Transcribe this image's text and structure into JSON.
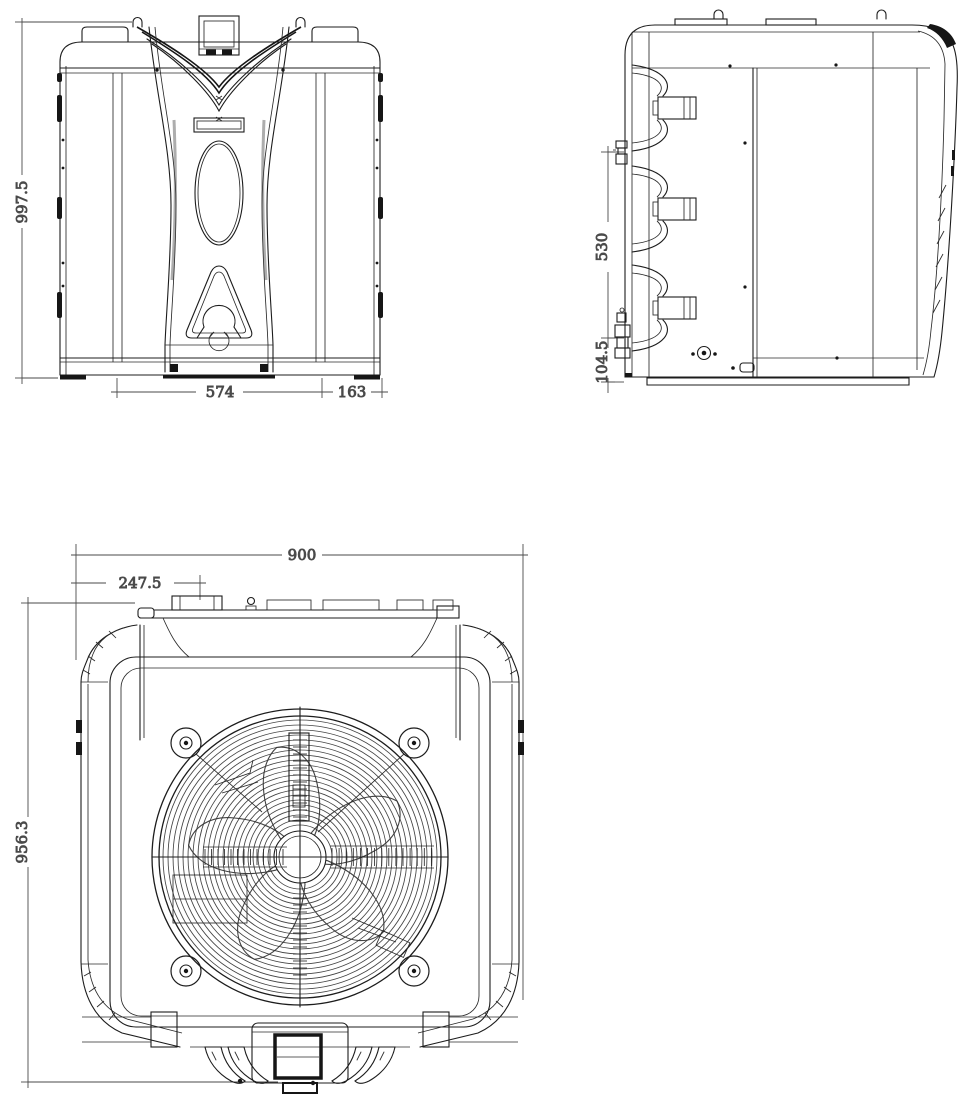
{
  "colors": {
    "line": "#1c1c1c",
    "dimension": "#4a4a4a",
    "background": "#ffffff"
  },
  "dimensions": {
    "front_view": {
      "height": "997.5",
      "base_width": "574",
      "base_right_width": "163"
    },
    "side_view": {
      "connection_span": "530",
      "base_height": "104.5"
    },
    "plan_view": {
      "overall_width": "900",
      "display_offset": "247.5",
      "overall_depth": "956.3"
    }
  }
}
